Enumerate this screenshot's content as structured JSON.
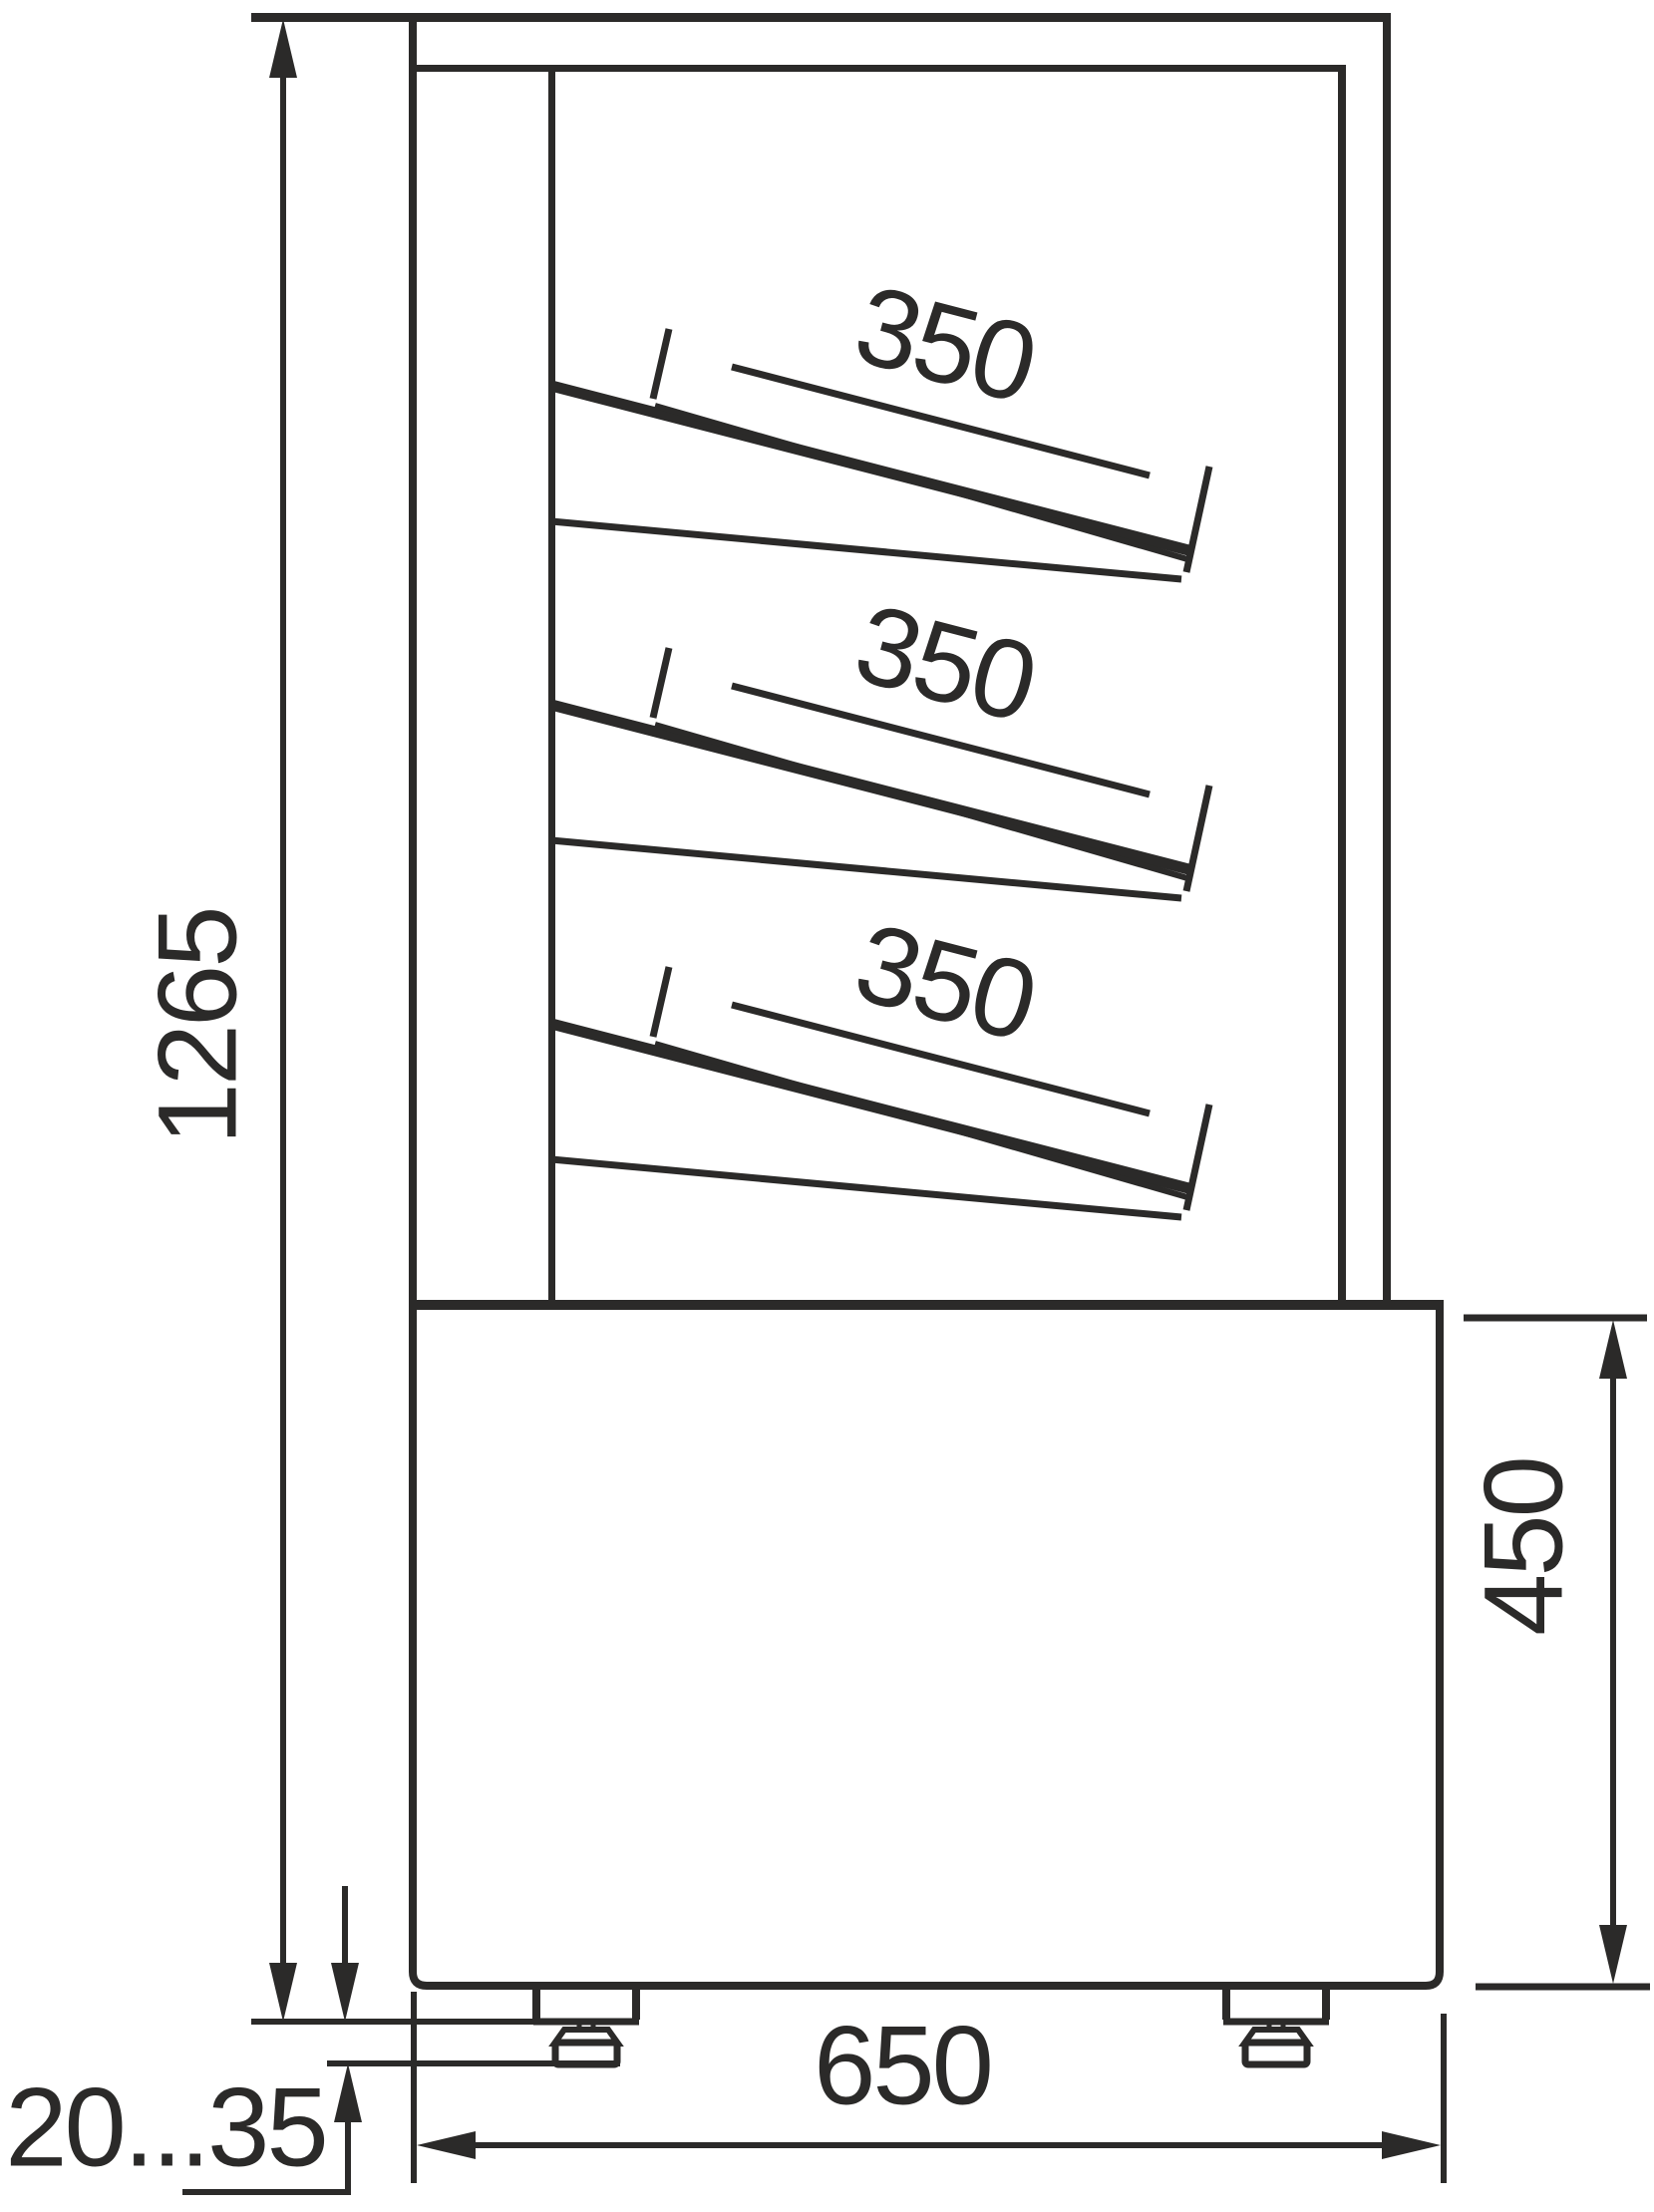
{
  "drawing": {
    "type": "technical-dimension-drawing",
    "subject": "refrigerated display case side view with three sloped shelves, base cabinet and adjustable feet",
    "colors": {
      "line": "#2b2a29",
      "background": "#ffffff"
    },
    "dimensions": {
      "overall_height": {
        "value": "1265",
        "orientation": "vertical",
        "location": "left side"
      },
      "shelves": [
        {
          "depth": "350",
          "orientation": "sloped",
          "location": "top shelf"
        },
        {
          "depth": "350",
          "orientation": "sloped",
          "location": "middle shelf"
        },
        {
          "depth": "350",
          "orientation": "sloped",
          "location": "bottom shelf"
        }
      ],
      "base_height": {
        "value": "450",
        "orientation": "vertical",
        "location": "right side"
      },
      "base_depth": {
        "value": "650",
        "orientation": "horizontal",
        "location": "bottom"
      },
      "foot_adjustment": {
        "value": "20...35",
        "orientation": "horizontal",
        "location": "bottom left"
      }
    }
  }
}
